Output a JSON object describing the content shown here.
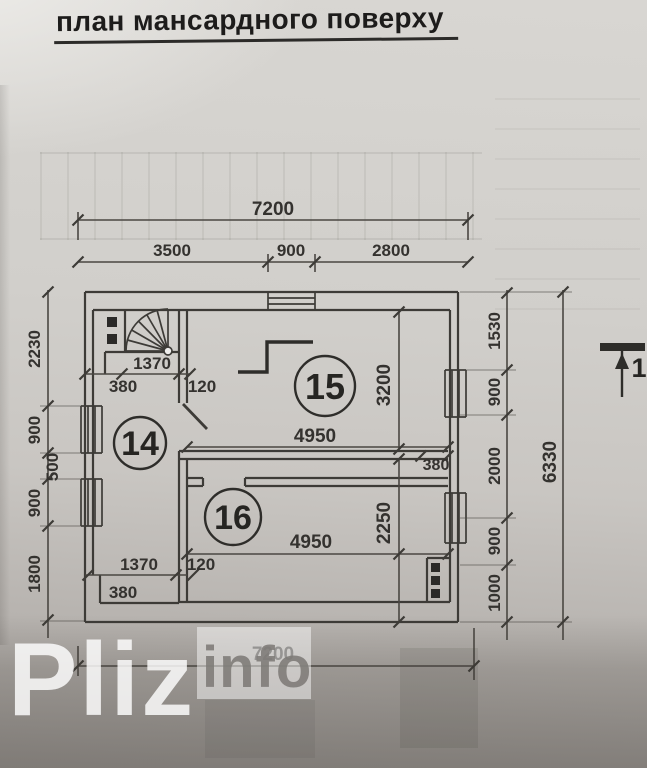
{
  "title": "план мансардного поверху",
  "drawing": {
    "rooms": [
      {
        "number": "14"
      },
      {
        "number": "15"
      },
      {
        "number": "16"
      }
    ],
    "section_marker": "1"
  },
  "dimensions": {
    "top_total": "7200",
    "top_segments": [
      "3500",
      "900",
      "2800"
    ],
    "left_segments": [
      "2230",
      "900",
      "500",
      "900",
      "1800"
    ],
    "right_segments": [
      "1530",
      "900",
      "2000",
      "900",
      "1000"
    ],
    "right_total": "6330",
    "stair_width_top": "1370",
    "stair_offset_top": "380",
    "door_wall_top": "120",
    "room15_width": "4950",
    "room15_depth": "3200",
    "right_pier": "380",
    "room16_width": "4950",
    "room16_depth": "2250",
    "stair_width_bottom": "1370",
    "stair_offset_bottom": "380",
    "door_wall_bottom": "120",
    "bottom_total": "7200"
  },
  "watermark": {
    "brand": "Pliz",
    "suffix": "info"
  },
  "colors": {
    "ink": "#3d3b37",
    "paper_light": "#d8d6d2",
    "paper_dark": "#a19d99",
    "watermark_gray": "#7d7a76"
  }
}
